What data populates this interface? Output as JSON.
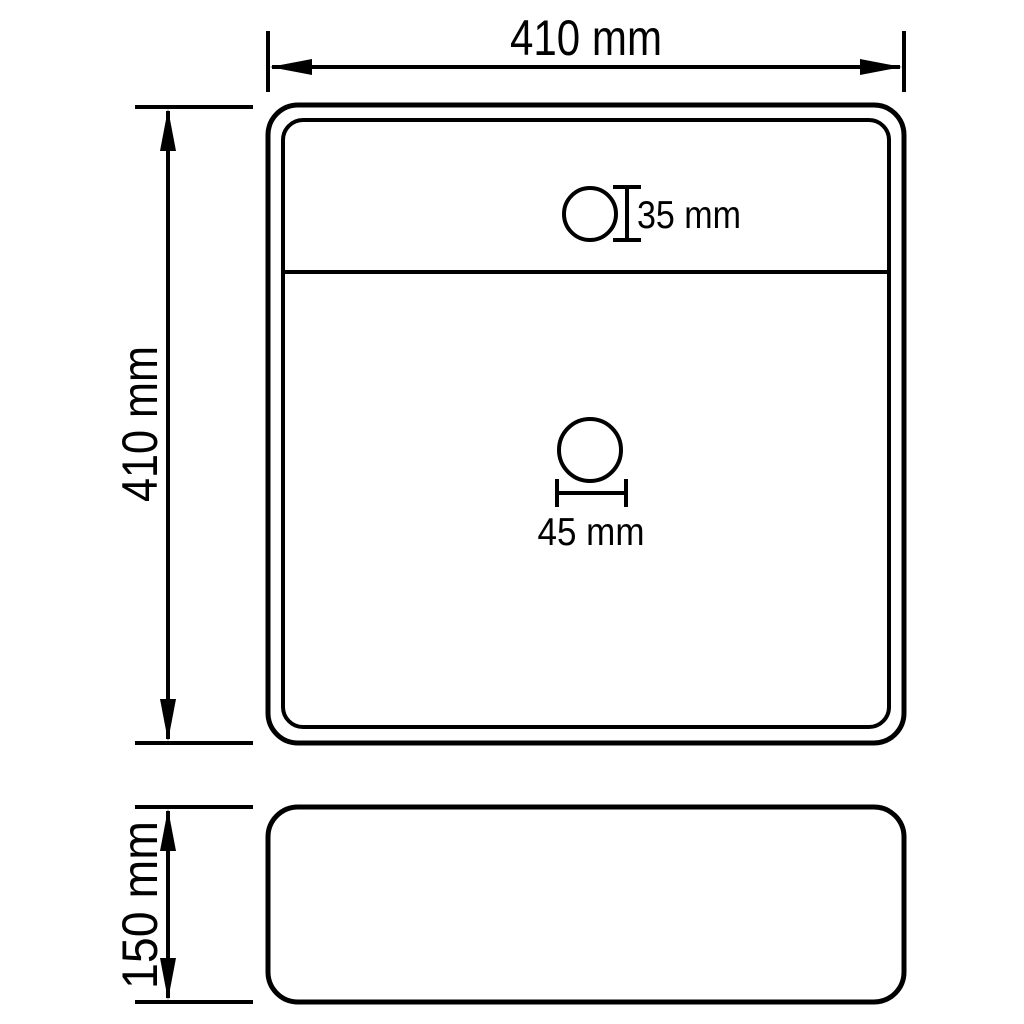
{
  "diagram": {
    "kind": "technical-dimension-drawing",
    "subject": "square countertop washbasin with faucet hole, top view and side view",
    "background_color": "#ffffff",
    "line_color": "#000000",
    "views": {
      "top": {
        "width_label": "410 mm",
        "height_label": "410 mm",
        "faucet_hole_label": "35 mm",
        "drain_hole_label": "45 mm"
      },
      "side": {
        "height_label": "150 mm"
      }
    }
  }
}
